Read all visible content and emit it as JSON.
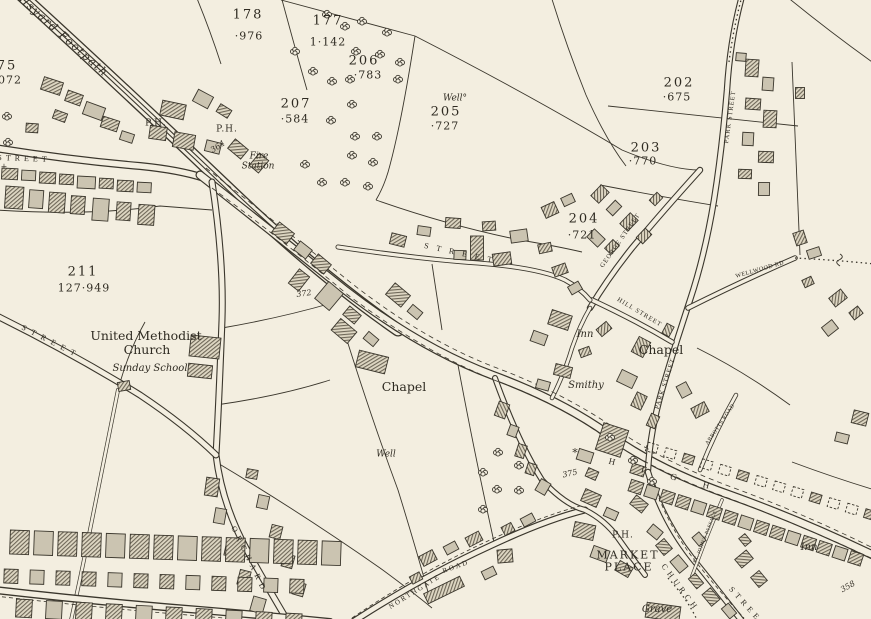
{
  "map": {
    "kind": "victorian-ordnance-survey-town-plan",
    "colors": {
      "paper": "#f3eee0",
      "ink": "#3a362c",
      "building_grey": "#cbc4b1",
      "hatch": "#6e6758"
    },
    "labels": {
      "parcels": [
        {
          "number": "177",
          "area": "1·142",
          "x": 328,
          "y": 21,
          "area_x": 328,
          "area_y": 42
        },
        {
          "number": "178",
          "area": "·976",
          "x": 248,
          "y": 15,
          "area_x": 249,
          "area_y": 36
        },
        {
          "number": "206",
          "area": "·783",
          "x": 364,
          "y": 61,
          "area_x": 368,
          "area_y": 75
        },
        {
          "number": "205",
          "area": "·727",
          "x": 446,
          "y": 112,
          "area_x": 445,
          "area_y": 126
        },
        {
          "number": "207",
          "area": "·584",
          "x": 296,
          "y": 104,
          "area_x": 295,
          "area_y": 119
        },
        {
          "number": "202",
          "area": "·675",
          "x": 679,
          "y": 83,
          "area_x": 677,
          "area_y": 97
        },
        {
          "number": "203",
          "area": "·770",
          "x": 646,
          "y": 148,
          "area_x": 643,
          "area_y": 161
        },
        {
          "number": "204",
          "area": "·721",
          "x": 584,
          "y": 219,
          "area_x": 582,
          "area_y": 235
        },
        {
          "number": "211",
          "area": "127·949",
          "x": 83,
          "y": 272,
          "area_x": 84,
          "area_y": 288
        },
        {
          "number": "75",
          "area": "072",
          "x": 7,
          "y": 66,
          "area_x": 10,
          "area_y": 80
        }
      ],
      "streets": [
        {
          "name": "malsyard-footpath",
          "text": "Malsyard Footpath",
          "x": 58,
          "y": 31,
          "rot": 42,
          "style": "italic",
          "size": 11,
          "ls": 1.5
        },
        {
          "name": "street-top-left",
          "text": "STREET",
          "x": 24,
          "y": 159,
          "rot": 2,
          "style": "caps",
          "size": 8,
          "ls": 4
        },
        {
          "name": "park-street-upper",
          "text": "PARK STREET",
          "x": 731,
          "y": 117,
          "rot": -82,
          "style": "caps",
          "size": 6.5,
          "ls": 1
        },
        {
          "name": "george-street",
          "text": "GEORGE STREET",
          "x": 621,
          "y": 241,
          "rot": -55,
          "style": "caps",
          "size": 6.5,
          "ls": 1
        },
        {
          "name": "hill-street",
          "text": "HILL STREET",
          "x": 639,
          "y": 313,
          "rot": 31,
          "style": "caps",
          "size": 6.5,
          "ls": 1
        },
        {
          "name": "park-street-lower",
          "text": "PARK STREET",
          "x": 666,
          "y": 384,
          "rot": -72,
          "style": "caps",
          "size": 6.5,
          "ls": 1
        },
        {
          "name": "wellwood-rd",
          "text": "WELLWOOD RD",
          "x": 760,
          "y": 270,
          "rot": -16,
          "style": "caps",
          "size": 6,
          "ls": 0.5
        },
        {
          "name": "street-central",
          "text": "STREET",
          "x": 462,
          "y": 254,
          "rot": 12,
          "style": "caps",
          "size": 8,
          "ls": 8
        },
        {
          "name": "street-lower-left",
          "text": "STREET",
          "x": 51,
          "y": 342,
          "rot": 27,
          "style": "caps",
          "size": 8,
          "ls": 6
        },
        {
          "name": "orchard-street",
          "text": "ORCHARD",
          "x": 249,
          "y": 560,
          "rot": 64,
          "style": "caps",
          "size": 8,
          "ls": 5
        },
        {
          "name": "northgate-road-1",
          "text": "NORTHGATE",
          "x": 415,
          "y": 592,
          "rot": -32,
          "style": "caps",
          "size": 7,
          "ls": 2
        },
        {
          "name": "northgate-road-2",
          "text": "ROAD",
          "x": 456,
          "y": 567,
          "rot": -20,
          "style": "caps",
          "size": 7,
          "ls": 2
        },
        {
          "name": "high-street-letters",
          "text": "HIGH",
          "x": 672,
          "y": 477,
          "rot": 14,
          "style": "caps",
          "size": 9,
          "ls": 27
        },
        {
          "name": "church-street-1",
          "text": "CHURCH",
          "x": 680,
          "y": 588,
          "rot": 53,
          "style": "caps",
          "size": 8,
          "ls": 4
        },
        {
          "name": "church-street-2",
          "text": "STREET",
          "x": 748,
          "y": 608,
          "rot": 48,
          "style": "caps",
          "size": 8,
          "ls": 4
        },
        {
          "name": "st-johns-passage",
          "text": "ST. JOHN'S PASSAGE",
          "x": 706,
          "y": 537,
          "rot": -68,
          "style": "caps",
          "size": 5,
          "ls": 0.5
        },
        {
          "name": "abbotts-road",
          "text": "ABBOTTS ROAD",
          "x": 721,
          "y": 425,
          "rot": -56,
          "style": "caps",
          "size": 5.5,
          "ls": 0.5
        }
      ],
      "places": [
        {
          "name": "public-house-1",
          "text": "P.H.",
          "x": 156,
          "y": 124,
          "style": "serif",
          "size": 9,
          "ls": 1
        },
        {
          "name": "public-house-2",
          "text": "P.H.",
          "x": 227,
          "y": 130,
          "style": "serif",
          "size": 9,
          "ls": 1
        },
        {
          "name": "fire-station-1",
          "text": "Fire",
          "x": 259,
          "y": 157,
          "style": "italic",
          "size": 9
        },
        {
          "name": "fire-station-2",
          "text": "Station",
          "x": 258,
          "y": 167,
          "style": "italic",
          "size": 9
        },
        {
          "name": "methodist-church-1",
          "text": "United Methodist",
          "x": 146,
          "y": 336,
          "style": "serif",
          "size": 12.5
        },
        {
          "name": "methodist-church-2",
          "text": "Church",
          "x": 147,
          "y": 350,
          "style": "serif",
          "size": 12.5
        },
        {
          "name": "sunday-school",
          "text": "Sunday School",
          "x": 150,
          "y": 369,
          "style": "italic",
          "size": 10
        },
        {
          "name": "chapel-central",
          "text": "Chapel",
          "x": 404,
          "y": 387,
          "style": "serif",
          "size": 12.5
        },
        {
          "name": "chapel-east",
          "text": "Chapel",
          "x": 661,
          "y": 350,
          "style": "serif",
          "size": 12.5
        },
        {
          "name": "inn-central",
          "text": "Inn",
          "x": 585,
          "y": 335,
          "style": "italic",
          "size": 10
        },
        {
          "name": "smithy",
          "text": "Smithy",
          "x": 586,
          "y": 386,
          "style": "italic",
          "size": 10
        },
        {
          "name": "well-north",
          "text": "Well°",
          "x": 455,
          "y": 99,
          "style": "italic",
          "size": 9
        },
        {
          "name": "well-south",
          "text": "Well",
          "x": 386,
          "y": 455,
          "style": "italic",
          "size": 9
        },
        {
          "name": "public-house-3",
          "text": "P.H.",
          "x": 623,
          "y": 536,
          "style": "serif",
          "size": 9,
          "ls": 1
        },
        {
          "name": "market-place-1",
          "text": "MARKET",
          "x": 628,
          "y": 555,
          "style": "serif-caps",
          "size": 11,
          "ls": 2
        },
        {
          "name": "market-place-2",
          "text": "PLACE",
          "x": 629,
          "y": 567,
          "style": "serif-caps",
          "size": 11,
          "ls": 2
        },
        {
          "name": "inn-east",
          "text": "Inn",
          "x": 809,
          "y": 548,
          "style": "italic",
          "size": 10
        },
        {
          "name": "grave-yard",
          "text": "Grave",
          "x": 657,
          "y": 610,
          "style": "italic",
          "size": 10
        }
      ],
      "benchmarks": [
        {
          "text": "364",
          "x": 218,
          "y": 147,
          "rot": -33
        },
        {
          "text": "372",
          "x": 304,
          "y": 294,
          "rot": -8
        },
        {
          "text": "375",
          "x": 570,
          "y": 474,
          "rot": -12
        },
        {
          "text": "358",
          "x": 848,
          "y": 587,
          "rot": -30
        }
      ],
      "features": [
        {
          "name": "survey-star",
          "text": "*",
          "x": 575,
          "y": 453,
          "size": 11
        },
        {
          "name": "survey-cross",
          "text": "+",
          "x": 4,
          "y": 167,
          "size": 8
        }
      ]
    }
  }
}
